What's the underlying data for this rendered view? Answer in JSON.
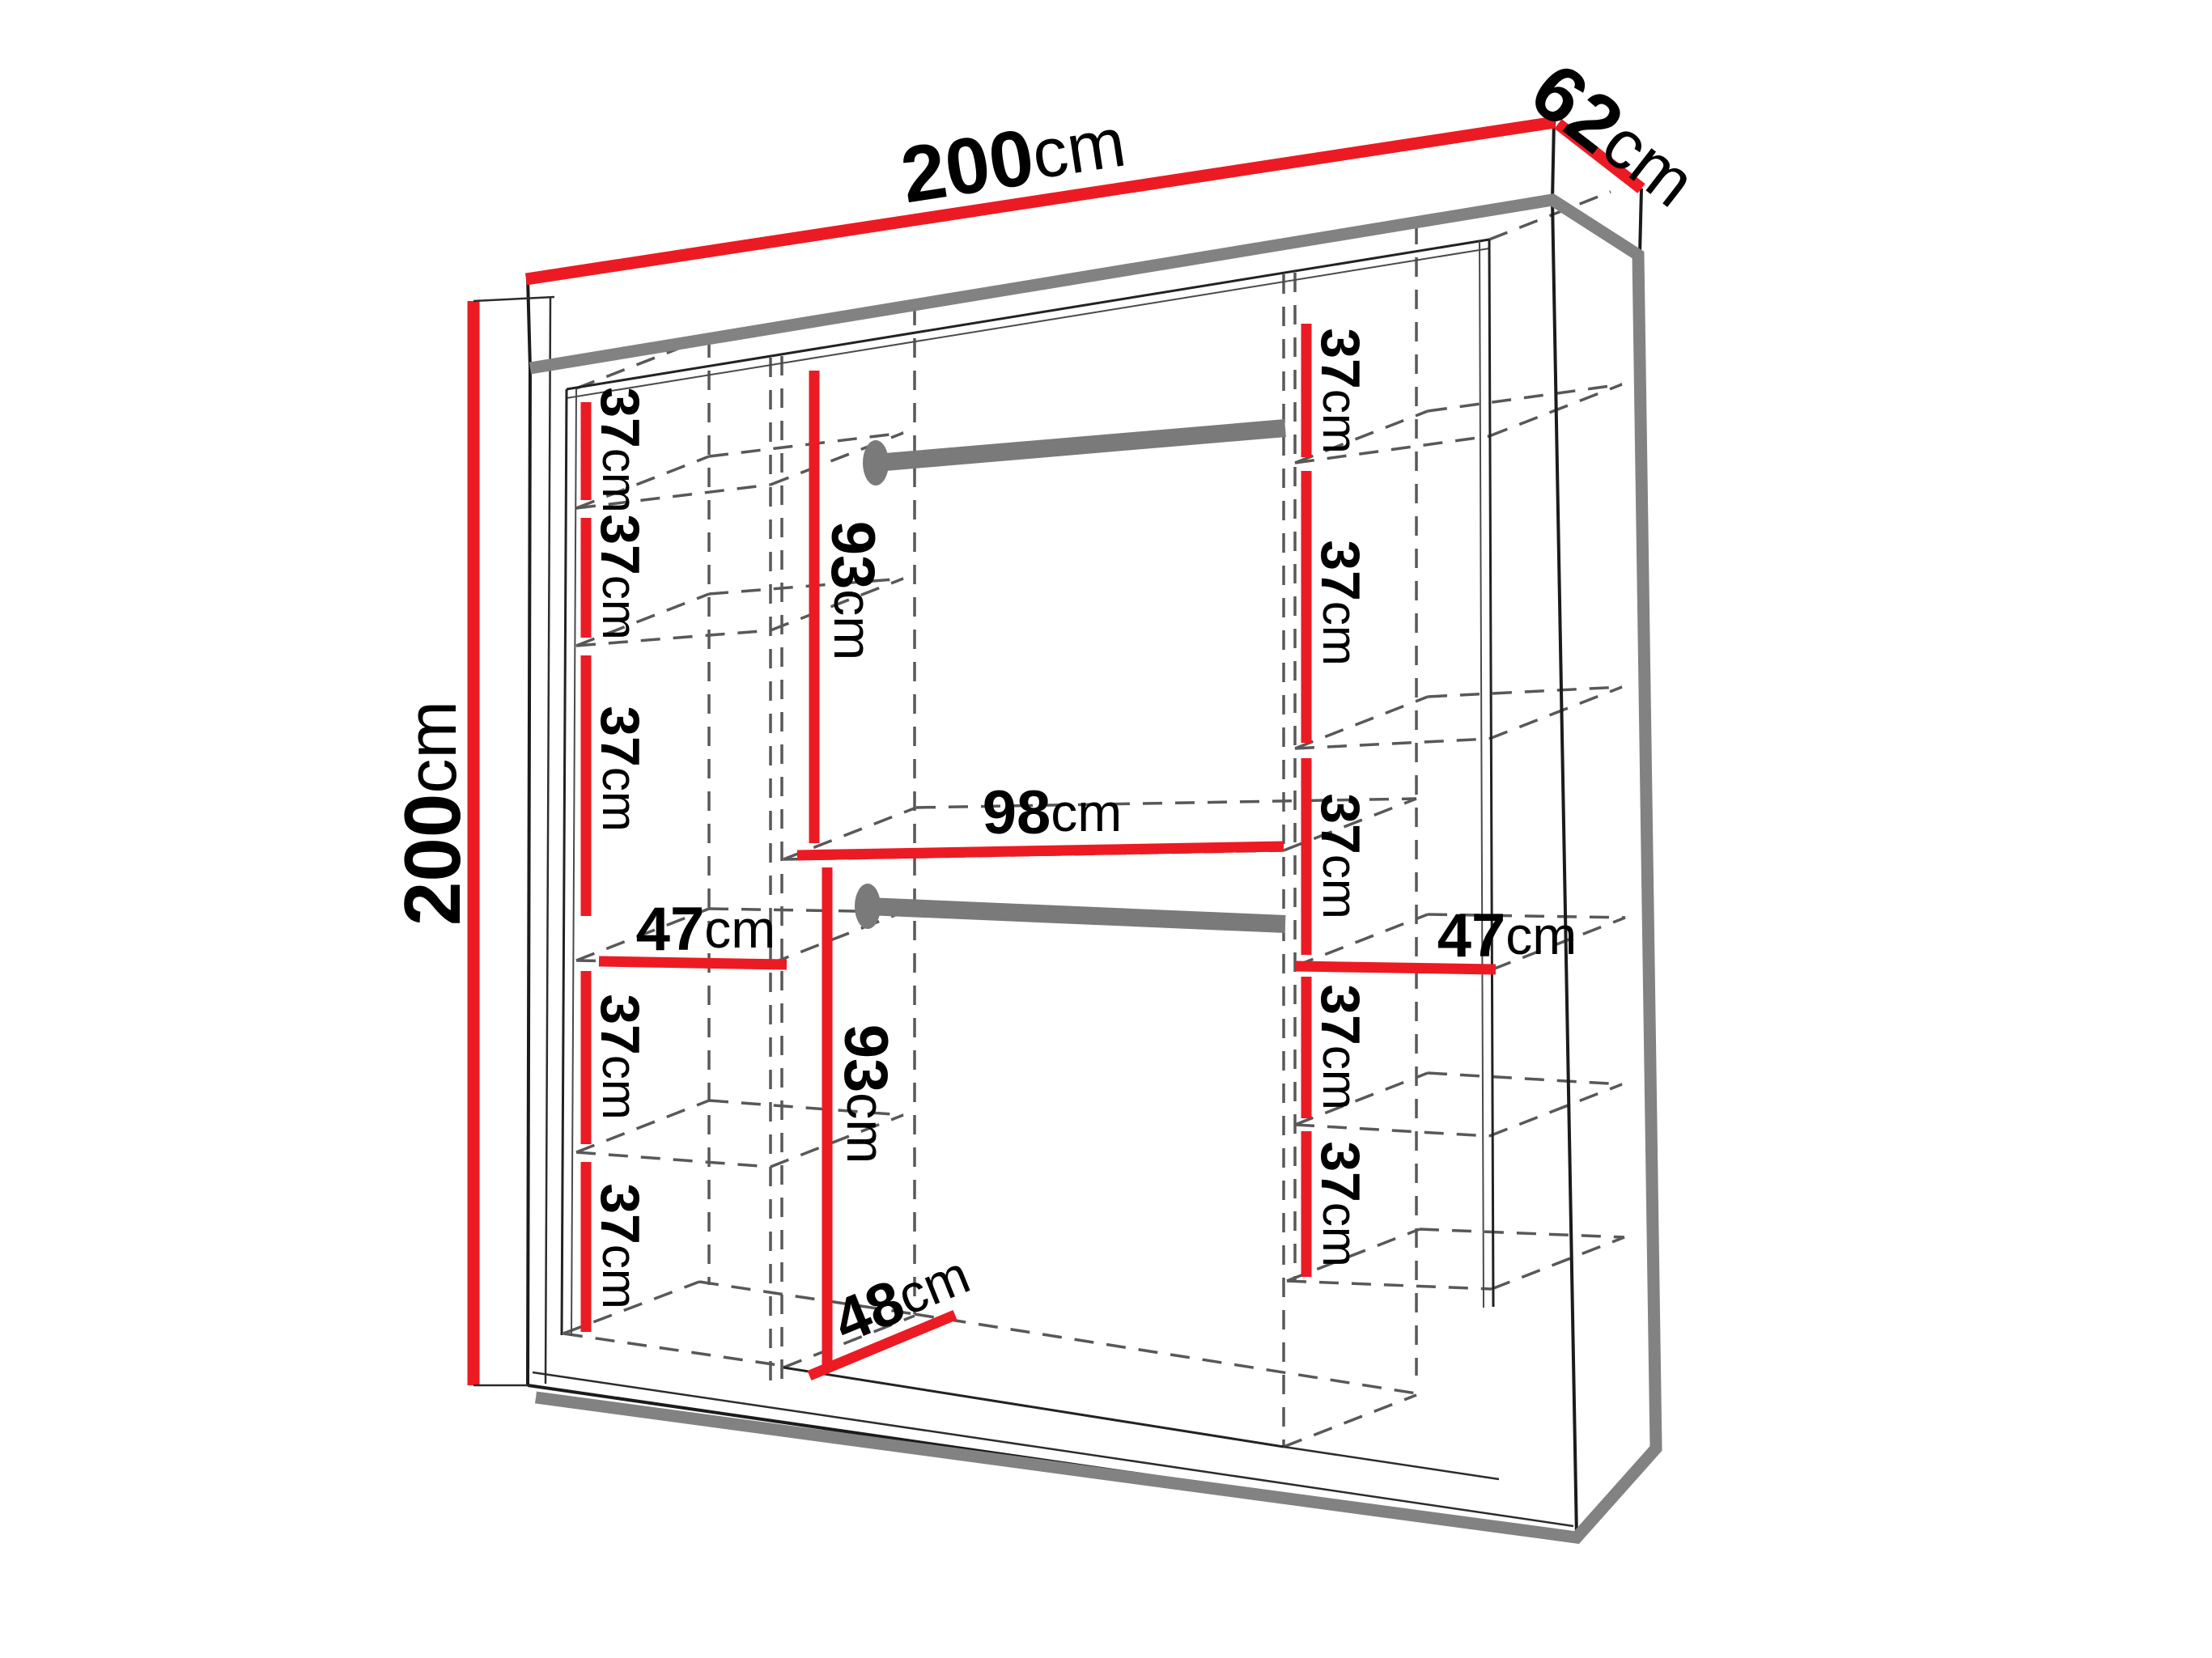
{
  "drawing": {
    "type": "furniture-dimension-diagram",
    "subject": "two-door sliding wardrobe, front cutaway view with interior shelving and hanging rods",
    "unit": "cm",
    "colors": {
      "dimension_line": "#ec1b23",
      "outline_shadow": "#828282",
      "drawing_line": "#1b1b1b",
      "hidden_line": "#585858",
      "rod": "#7a7a7a",
      "label": "#000000",
      "background": "#ffffff"
    },
    "overall": {
      "width": {
        "value": "200",
        "unit": "cm"
      },
      "depth": {
        "value": "62",
        "unit": "cm"
      },
      "height": {
        "value": "200",
        "unit": "cm"
      }
    },
    "left_column": {
      "width": {
        "value": "47",
        "unit": "cm"
      },
      "gaps": [
        {
          "value": "37",
          "unit": "cm"
        },
        {
          "value": "37",
          "unit": "cm"
        },
        {
          "value": "37",
          "unit": "cm"
        },
        {
          "value": "37",
          "unit": "cm"
        },
        {
          "value": "37",
          "unit": "cm"
        }
      ]
    },
    "middle_section": {
      "width": {
        "value": "98",
        "unit": "cm"
      },
      "upper_section_height": {
        "value": "93",
        "unit": "cm"
      },
      "lower_section_height": {
        "value": "93",
        "unit": "cm"
      },
      "bottom_depth": {
        "value": "48",
        "unit": "cm"
      },
      "hanging_rods": 2
    },
    "right_column": {
      "width": {
        "value": "47",
        "unit": "cm"
      },
      "gaps": [
        {
          "value": "37",
          "unit": "cm"
        },
        {
          "value": "37",
          "unit": "cm"
        },
        {
          "value": "37",
          "unit": "cm"
        },
        {
          "value": "37",
          "unit": "cm"
        },
        {
          "value": "37",
          "unit": "cm"
        }
      ]
    }
  }
}
